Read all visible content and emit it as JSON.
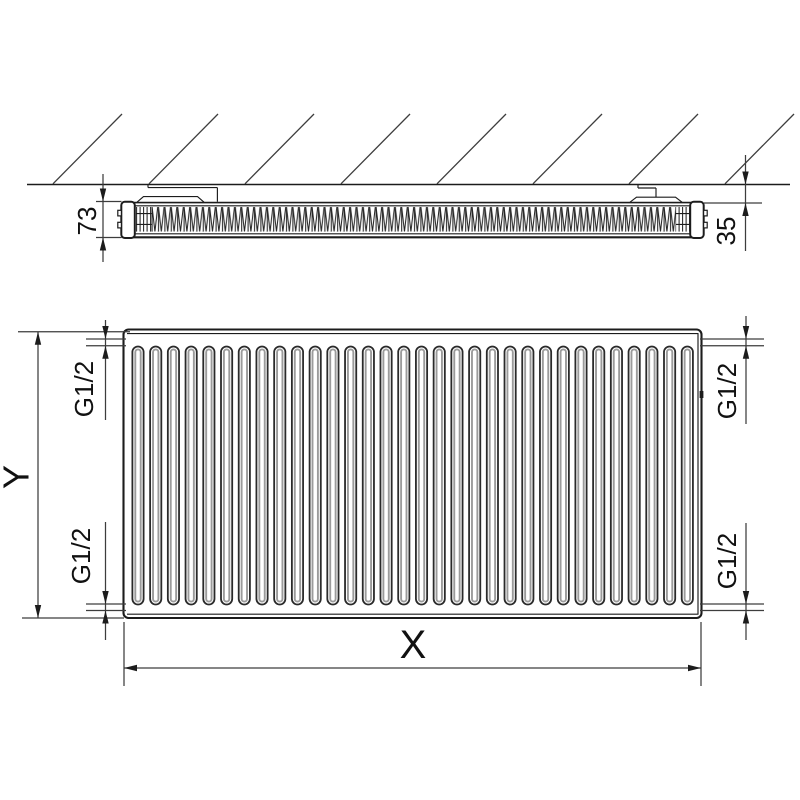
{
  "side_view": {
    "depth_dimension": "73",
    "wall_distance_dimension": "35"
  },
  "front_view": {
    "height_dimension": "Y",
    "width_dimension": "X",
    "flute_count": 32,
    "connections": [
      {
        "position": "top-left",
        "label": "G1/2"
      },
      {
        "position": "bottom-left",
        "label": "G1/2"
      },
      {
        "position": "top-right",
        "label": "G1/2"
      },
      {
        "position": "bottom-right",
        "label": "G1/2"
      }
    ]
  },
  "hatch_count": 8,
  "colors": {
    "line": "#1c1c1c",
    "dimension_line": "#3d3d3d",
    "flute_shading": "#9b9b9b",
    "background": "#ffffff"
  }
}
